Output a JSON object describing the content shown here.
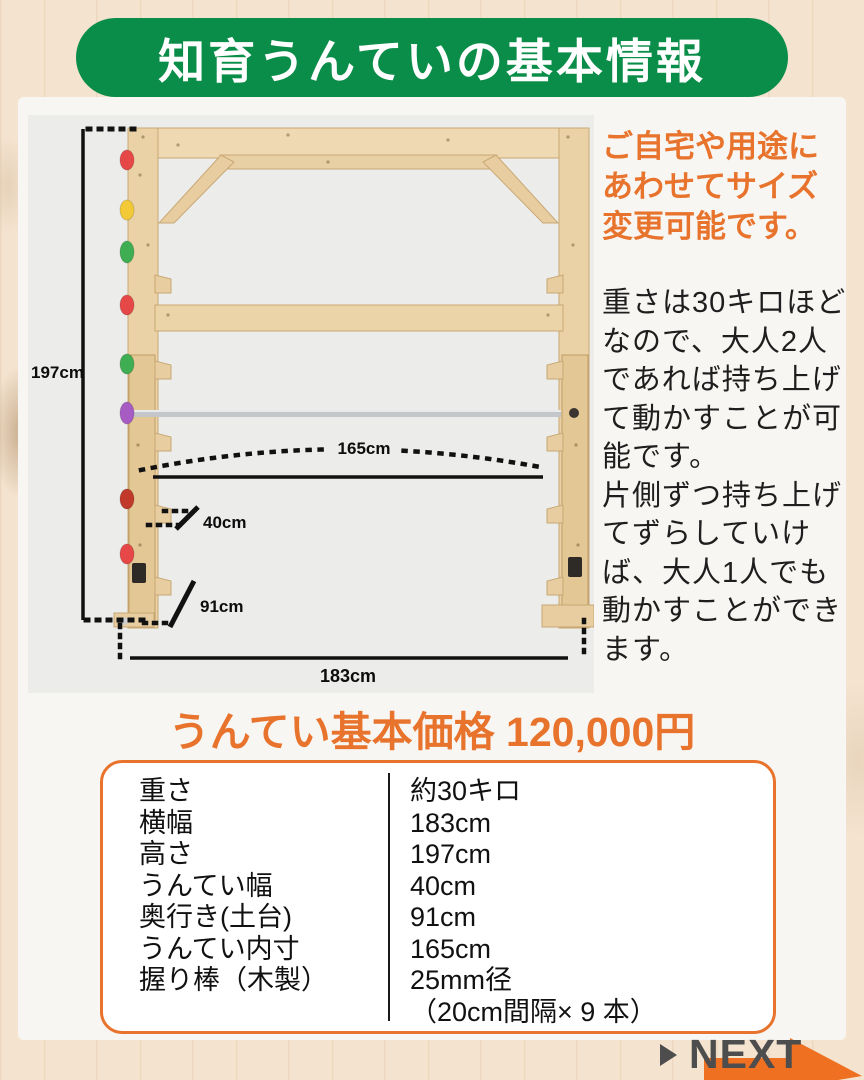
{
  "banner": {
    "title": "知育うんていの基本情報"
  },
  "intro": {
    "headline_lines": [
      "ご自宅や用途に",
      "あわせてサイズ",
      "変更可能です。"
    ],
    "body_lines": [
      "重さは30キロほど",
      "なので、大人2人",
      "であれば持ち上げ",
      "て動かすことが可",
      "能です。",
      "片側ずつ持ち上げ",
      "てずらしていけ",
      "ば、大人1人でも",
      "動かすことができ",
      "ます。"
    ]
  },
  "photo": {
    "dims": {
      "height": "197cm",
      "inner_span": "165cm",
      "rung_width": "40cm",
      "base_depth": "91cm",
      "total_width": "183cm"
    },
    "holds": [
      "#e64747",
      "#f2c937",
      "#3fae52",
      "#e64747",
      "#3fae52",
      "#a65cc2",
      "#c0392b",
      "#e64747"
    ]
  },
  "price": {
    "heading": "うんてい基本価格 120,000円"
  },
  "spec_table": {
    "rows": [
      {
        "label": "重さ",
        "value": "約30キロ"
      },
      {
        "label": "横幅",
        "value": "183cm"
      },
      {
        "label": "高さ",
        "value": "197cm"
      },
      {
        "label": "うんてい幅",
        "value": "40cm"
      },
      {
        "label": "奥行き(土台)",
        "value": "91cm"
      },
      {
        "label": "うんてい内寸",
        "value": "165cm"
      },
      {
        "label": "握り棒（木製）",
        "value": "25mm径",
        "value2": "（20cm間隔× 9 本）"
      }
    ]
  },
  "next": {
    "label": "NEXT"
  },
  "colors": {
    "banner_green": "#0b8d4a",
    "accent_orange": "#e8732c",
    "arrow_orange": "#ee7020",
    "next_gray": "#4d4d4d",
    "photo_bg": "#ececeb",
    "card_bg": "#f8f6f3",
    "wood_bg": "#f4e3cf"
  }
}
